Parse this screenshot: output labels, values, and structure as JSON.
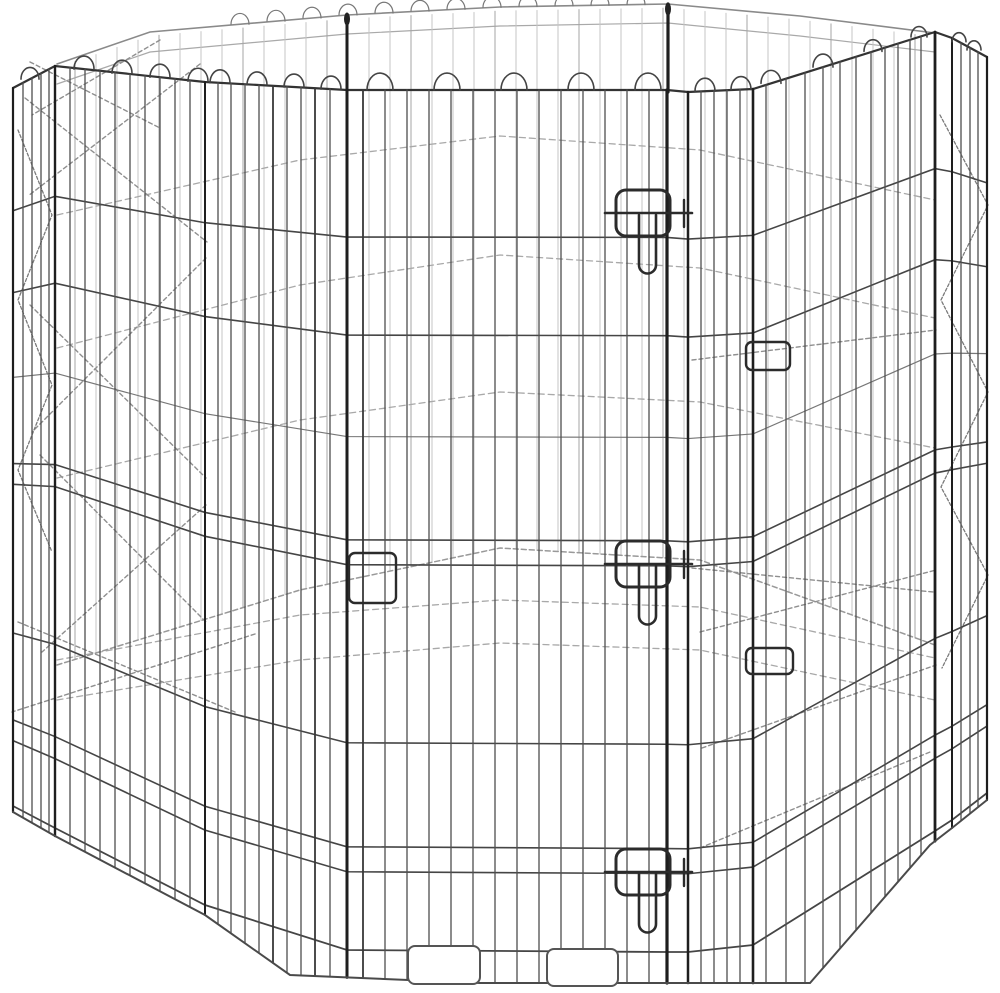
{
  "meta": {
    "alt": "Octagonal foldable metal wire pet exercise pen with a front door panel secured by three slide-bolt latches, shown on a plain white background"
  },
  "colors": {
    "background": "#ffffff",
    "front_wire": "#4f4f4f",
    "front_rail": "#454545",
    "top_rail": "#333333",
    "post": "#1e1e1e",
    "back_wire": "#c6c6c6",
    "back_wire_dark": "#a5a5a5",
    "back_rail": "#a9a9a9",
    "back_rim": "#8a8a8a",
    "diag": "#8f8f8f",
    "zigzag": "#7a7a7a",
    "latch": "#2b2b2b",
    "ground": "#4a4a4a",
    "foot": "#555555"
  },
  "scene": {
    "canvas": {
      "w": 1000,
      "h": 993
    },
    "front": {
      "top_edge": [
        [
          13,
          88
        ],
        [
          55,
          66
        ],
        [
          205,
          82
        ],
        [
          347,
          90
        ],
        [
          667,
          90
        ],
        [
          688,
          92
        ],
        [
          753,
          89
        ],
        [
          935,
          32
        ],
        [
          952,
          38
        ],
        [
          987,
          57
        ]
      ],
      "bottom_edge": [
        [
          13,
          806
        ],
        [
          55,
          828
        ],
        [
          205,
          905
        ],
        [
          347,
          950
        ],
        [
          667,
          952
        ],
        [
          688,
          952
        ],
        [
          753,
          945
        ],
        [
          935,
          831
        ],
        [
          952,
          820
        ],
        [
          987,
          793
        ]
      ],
      "ground": [
        [
          13,
          812
        ],
        [
          55,
          836
        ],
        [
          205,
          915
        ],
        [
          290,
          975
        ],
        [
          480,
          983
        ],
        [
          810,
          983
        ],
        [
          930,
          845
        ],
        [
          952,
          828
        ],
        [
          987,
          800
        ]
      ],
      "rail_fractions": [
        0,
        0.171,
        0.285,
        0.403,
        0.523,
        0.552,
        0.759,
        0.88,
        0.909,
        1
      ],
      "light_rail_index": 3,
      "seams": [
        [
          13,
          2.2
        ],
        [
          55,
          2.4
        ],
        [
          205,
          2
        ],
        [
          347,
          3
        ],
        [
          667,
          3.2
        ],
        [
          688,
          2.5
        ],
        [
          753,
          2.6
        ],
        [
          935,
          2.8
        ],
        [
          952,
          2
        ],
        [
          987,
          2.2
        ]
      ],
      "posts_above": [
        [
          347,
          15,
          90,
          3
        ],
        [
          668,
          4,
          92,
          3.2
        ]
      ],
      "caps": [
        [
          347,
          19
        ],
        [
          668,
          9
        ]
      ],
      "wires": [
        23,
        32,
        41,
        49,
        70,
        85,
        100,
        115,
        130,
        145,
        160,
        175,
        190,
        218,
        231,
        245,
        259,
        273,
        287,
        301,
        315,
        330,
        363,
        385,
        407,
        429,
        451,
        473,
        495,
        517,
        539,
        561,
        583,
        605,
        627,
        649,
        701,
        714,
        727,
        740,
        766,
        786,
        805,
        823,
        840,
        856,
        871,
        885,
        898,
        910,
        921,
        961,
        970,
        978
      ],
      "dark_wires": [
        273,
        315,
        363
      ],
      "bumps": [
        [
          30,
          9
        ],
        [
          84,
          10
        ],
        [
          122,
          10
        ],
        [
          160,
          10
        ],
        [
          198,
          10
        ],
        [
          220,
          10
        ],
        [
          257,
          10
        ],
        [
          294,
          10
        ],
        [
          331,
          10
        ],
        [
          380,
          13
        ],
        [
          447,
          13
        ],
        [
          514,
          13
        ],
        [
          581,
          13
        ],
        [
          648,
          13
        ],
        [
          705,
          10
        ],
        [
          741,
          10
        ],
        [
          771,
          10
        ],
        [
          823,
          10
        ],
        [
          873,
          9
        ],
        [
          919,
          8
        ],
        [
          959,
          7
        ],
        [
          974,
          7
        ]
      ]
    },
    "back": {
      "rim": [
        [
          57,
          64
        ],
        [
          150,
          32
        ],
        [
          347,
          15
        ],
        [
          500,
          7
        ],
        [
          668,
          4
        ],
        [
          800,
          16
        ],
        [
          935,
          33
        ]
      ],
      "rim_rail": [
        [
          57,
          84
        ],
        [
          150,
          52
        ],
        [
          347,
          34
        ],
        [
          500,
          26
        ],
        [
          668,
          23
        ],
        [
          800,
          36
        ],
        [
          935,
          52
        ]
      ],
      "floor": [
        [
          57,
          665
        ],
        [
          300,
          590
        ],
        [
          500,
          548
        ],
        [
          700,
          560
        ],
        [
          935,
          645
        ]
      ],
      "rails": [
        [
          [
            57,
            215
          ],
          [
            300,
            160
          ],
          [
            500,
            136
          ],
          [
            700,
            150
          ],
          [
            935,
            200
          ]
        ],
        [
          [
            57,
            348
          ],
          [
            300,
            285
          ],
          [
            500,
            255
          ],
          [
            700,
            268
          ],
          [
            935,
            318
          ]
        ],
        [
          [
            57,
            478
          ],
          [
            300,
            420
          ],
          [
            500,
            392
          ],
          [
            700,
            402
          ],
          [
            935,
            448
          ]
        ],
        [
          [
            57,
            660
          ],
          [
            300,
            615
          ],
          [
            500,
            600
          ],
          [
            700,
            607
          ],
          [
            935,
            658
          ]
        ],
        [
          [
            57,
            700
          ],
          [
            300,
            660
          ],
          [
            500,
            643
          ],
          [
            700,
            650
          ],
          [
            935,
            700
          ]
        ]
      ],
      "verticals": {
        "x0": 75,
        "x1": 925,
        "step": 21
      },
      "bumps": {
        "x0": 240,
        "x1": 664,
        "step": 36,
        "r": 9
      }
    },
    "diagonals": [
      [
        30,
        62,
        160,
        128
      ],
      [
        160,
        40,
        32,
        115
      ],
      [
        25,
        98,
        207,
        242
      ],
      [
        200,
        64,
        28,
        196
      ],
      [
        30,
        305,
        206,
        478
      ],
      [
        206,
        258,
        32,
        432
      ],
      [
        40,
        455,
        206,
        622
      ],
      [
        206,
        505,
        42,
        652
      ],
      [
        18,
        622,
        235,
        712
      ],
      [
        255,
        634,
        12,
        712
      ],
      [
        692,
        360,
        936,
        330
      ],
      [
        692,
        568,
        933,
        592
      ],
      [
        700,
        632,
        936,
        570
      ],
      [
        702,
        748,
        936,
        665
      ],
      [
        700,
        848,
        930,
        752
      ]
    ],
    "zigzags": [
      [
        [
          18,
          130
        ],
        [
          52,
          215
        ],
        [
          18,
          300
        ],
        [
          52,
          385
        ],
        [
          18,
          470
        ],
        [
          52,
          552
        ]
      ],
      [
        [
          940,
          115
        ],
        [
          988,
          205
        ],
        [
          941,
          300
        ],
        [
          988,
          392
        ],
        [
          941,
          487
        ],
        [
          988,
          575
        ],
        [
          942,
          668
        ]
      ]
    ],
    "latch_geom": {
      "loop_x": 616,
      "loop_w": 54,
      "loop_h": 46,
      "loop_dy": -23,
      "loop_rx": 10,
      "bolt_x0": 605,
      "bolt_x1": 692,
      "hook_x": 684,
      "handle_x0": 639,
      "handle_x1": 656,
      "handle_len": 52,
      "handle_r": 8.5
    },
    "latches": [
      {
        "name": "door-latch-top",
        "bolt_y": 213
      },
      {
        "name": "door-latch-middle",
        "bolt_y": 564
      },
      {
        "name": "door-latch-bottom",
        "bolt_y": 872
      }
    ],
    "clips": [
      {
        "name": "panel-clip-right-upper",
        "x": 746,
        "y": 342,
        "w": 44,
        "h": 28
      },
      {
        "name": "panel-clip-right-lower",
        "x": 746,
        "y": 648,
        "w": 47,
        "h": 26
      },
      {
        "name": "panel-clip-door-left",
        "x": 349,
        "y": 553,
        "w": 47,
        "h": 50
      }
    ],
    "feet": [
      {
        "name": "foot-plate-left",
        "x": 408,
        "y": 946,
        "w": 72,
        "h": 38
      },
      {
        "name": "foot-plate-right",
        "x": 547,
        "y": 949,
        "w": 71,
        "h": 37
      }
    ]
  }
}
